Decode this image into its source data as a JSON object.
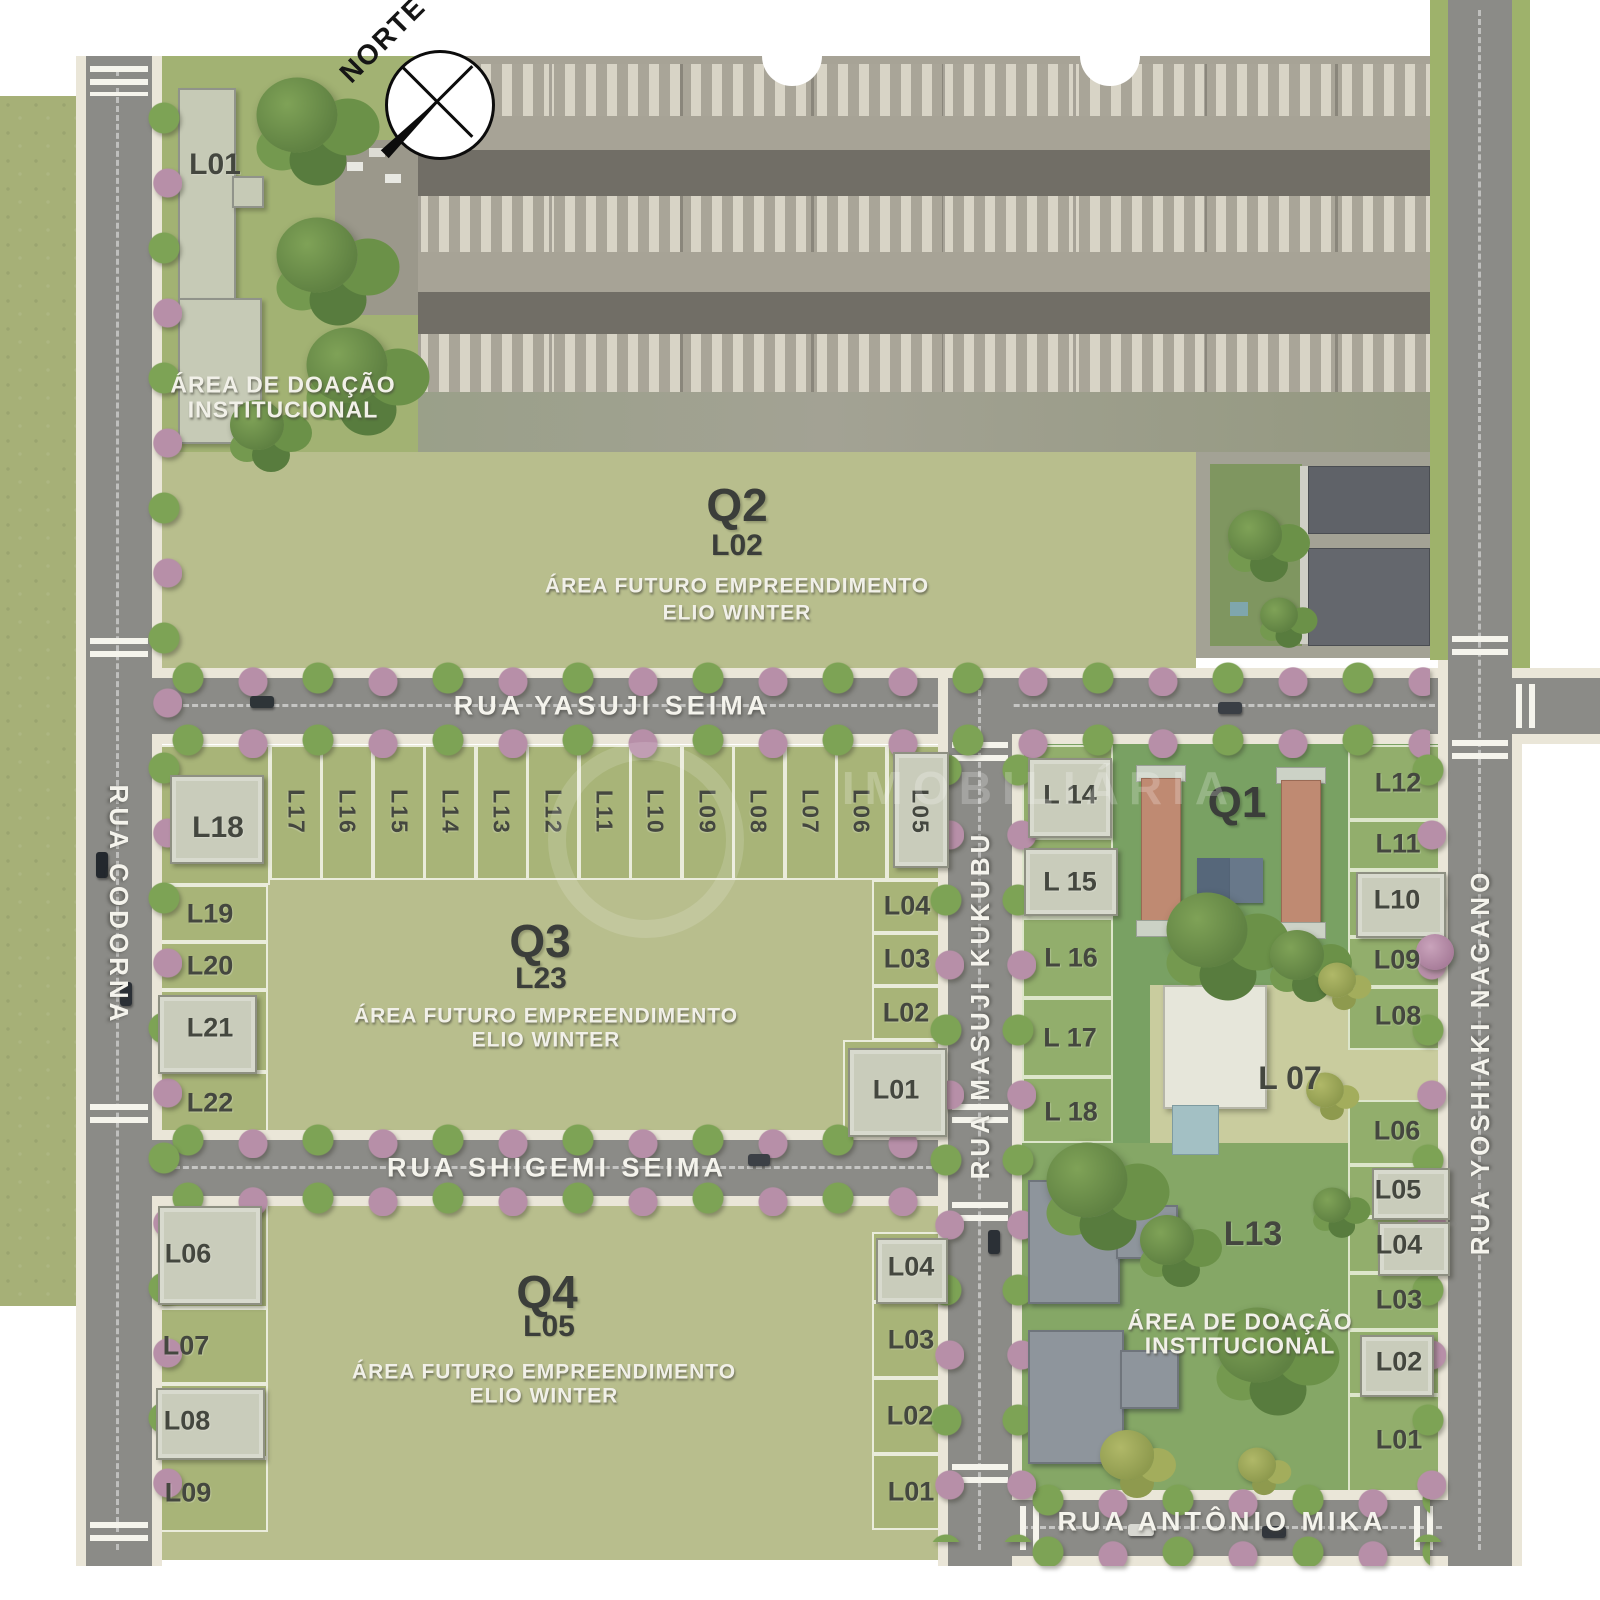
{
  "compass": {
    "label": "NORTE"
  },
  "watermark": {
    "text": "IMOBILIÁRIA"
  },
  "streets": {
    "yasuji_seima": "RUA YASUJI SEIMA",
    "shigemi_seima": "RUA SHIGEMI SEIMA",
    "antonio_mika": "RUA ANTÔNIO MIKA",
    "codorna": "RUA CODORNA",
    "masuji_kukubu": "RUA MASUJI KUKUBU",
    "yoshiaki_nagano": "RUA YOSHIAKI NAGANO"
  },
  "future_note": {
    "line1": "ÁREA FUTURO EMPREENDIMENTO",
    "line2": "ELIO WINTER"
  },
  "donation_note": {
    "line1": "ÁREA DE DOAÇÃO",
    "line2": "INSTITUCIONAL"
  },
  "northwest_area": {
    "lot": "L01"
  },
  "q2": {
    "label": "Q2",
    "lot": "L02"
  },
  "q3": {
    "label": "Q3",
    "lot": "L23",
    "corner_nw": "L18",
    "corner_ne": "L05",
    "top_row": [
      "L17",
      "L16",
      "L15",
      "L14",
      "L13",
      "L12",
      "L11",
      "L10",
      "L09",
      "L08",
      "L07",
      "L06"
    ],
    "west_col": [
      "L19",
      "L20",
      "L21",
      "L22"
    ],
    "east_col": [
      "L04",
      "L03",
      "L02",
      "L01"
    ]
  },
  "q4": {
    "label": "Q4",
    "lot": "L05",
    "west_col": [
      "L06",
      "L07",
      "L08",
      "L09"
    ],
    "east_col": [
      "L04",
      "L03",
      "L02",
      "L01"
    ]
  },
  "q1": {
    "label": "Q1",
    "big_lot": "L 07",
    "donation_lot": "L13",
    "west_col": [
      "L 14",
      "L 15",
      "L 16",
      "L 17",
      "L 18"
    ],
    "east_col_north": [
      "L12",
      "L11",
      "L10",
      "L09",
      "L08"
    ],
    "east_col_south": [
      "L06",
      "L05",
      "L04",
      "L03",
      "L02",
      "L01"
    ]
  },
  "colors": {
    "future_area": "#b8be8d",
    "lot_green": "#a8b478",
    "q1_green": "#79a163",
    "road_gray": "#8b8b87",
    "sidewalk": "#eae6d8",
    "tree_green": "#7da355",
    "tree_pink": "#b78fa8",
    "terracotta_building": "#bf8a72"
  }
}
